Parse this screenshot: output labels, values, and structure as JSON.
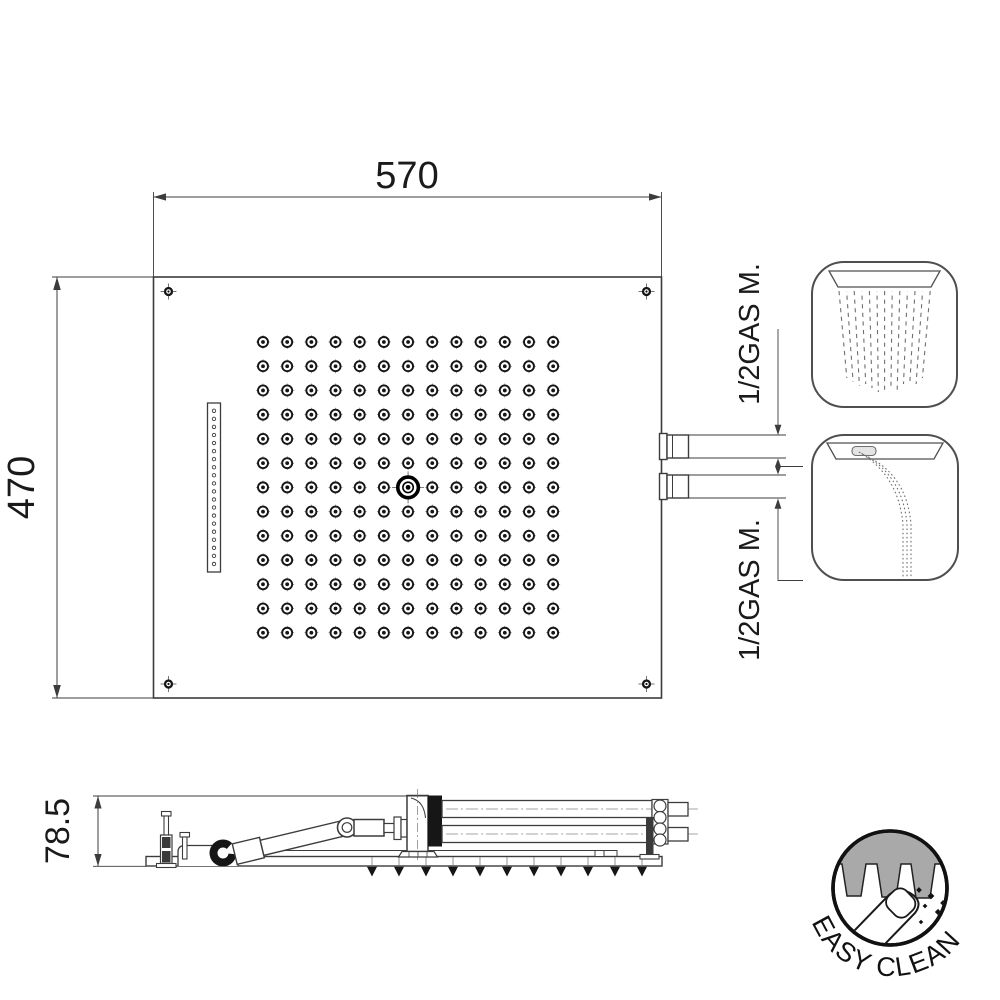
{
  "top_view": {
    "dim_width": "570",
    "dim_height": "470",
    "connection_label_1": "1/2GAS M.",
    "connection_label_2": "1/2GAS M.",
    "nozzle_grid": {
      "rows": 13,
      "cols": 13,
      "center_row": 7,
      "center_col": 7
    },
    "waterfall_slot_holes": 20,
    "corner_screws": 4
  },
  "side_view": {
    "dim_height": "78.5",
    "spray_nozzles": 11
  },
  "icons": [
    {
      "name": "rain-spray-icon"
    },
    {
      "name": "waterfall-spray-icon"
    }
  ],
  "badge": {
    "label": "EASY CLEAN"
  },
  "colors": {
    "line": "#3c3c3c",
    "dark": "#161616",
    "gray_fill": "#a9a9a9",
    "icon_line": "#6f6f6f",
    "bg": "#ffffff"
  }
}
